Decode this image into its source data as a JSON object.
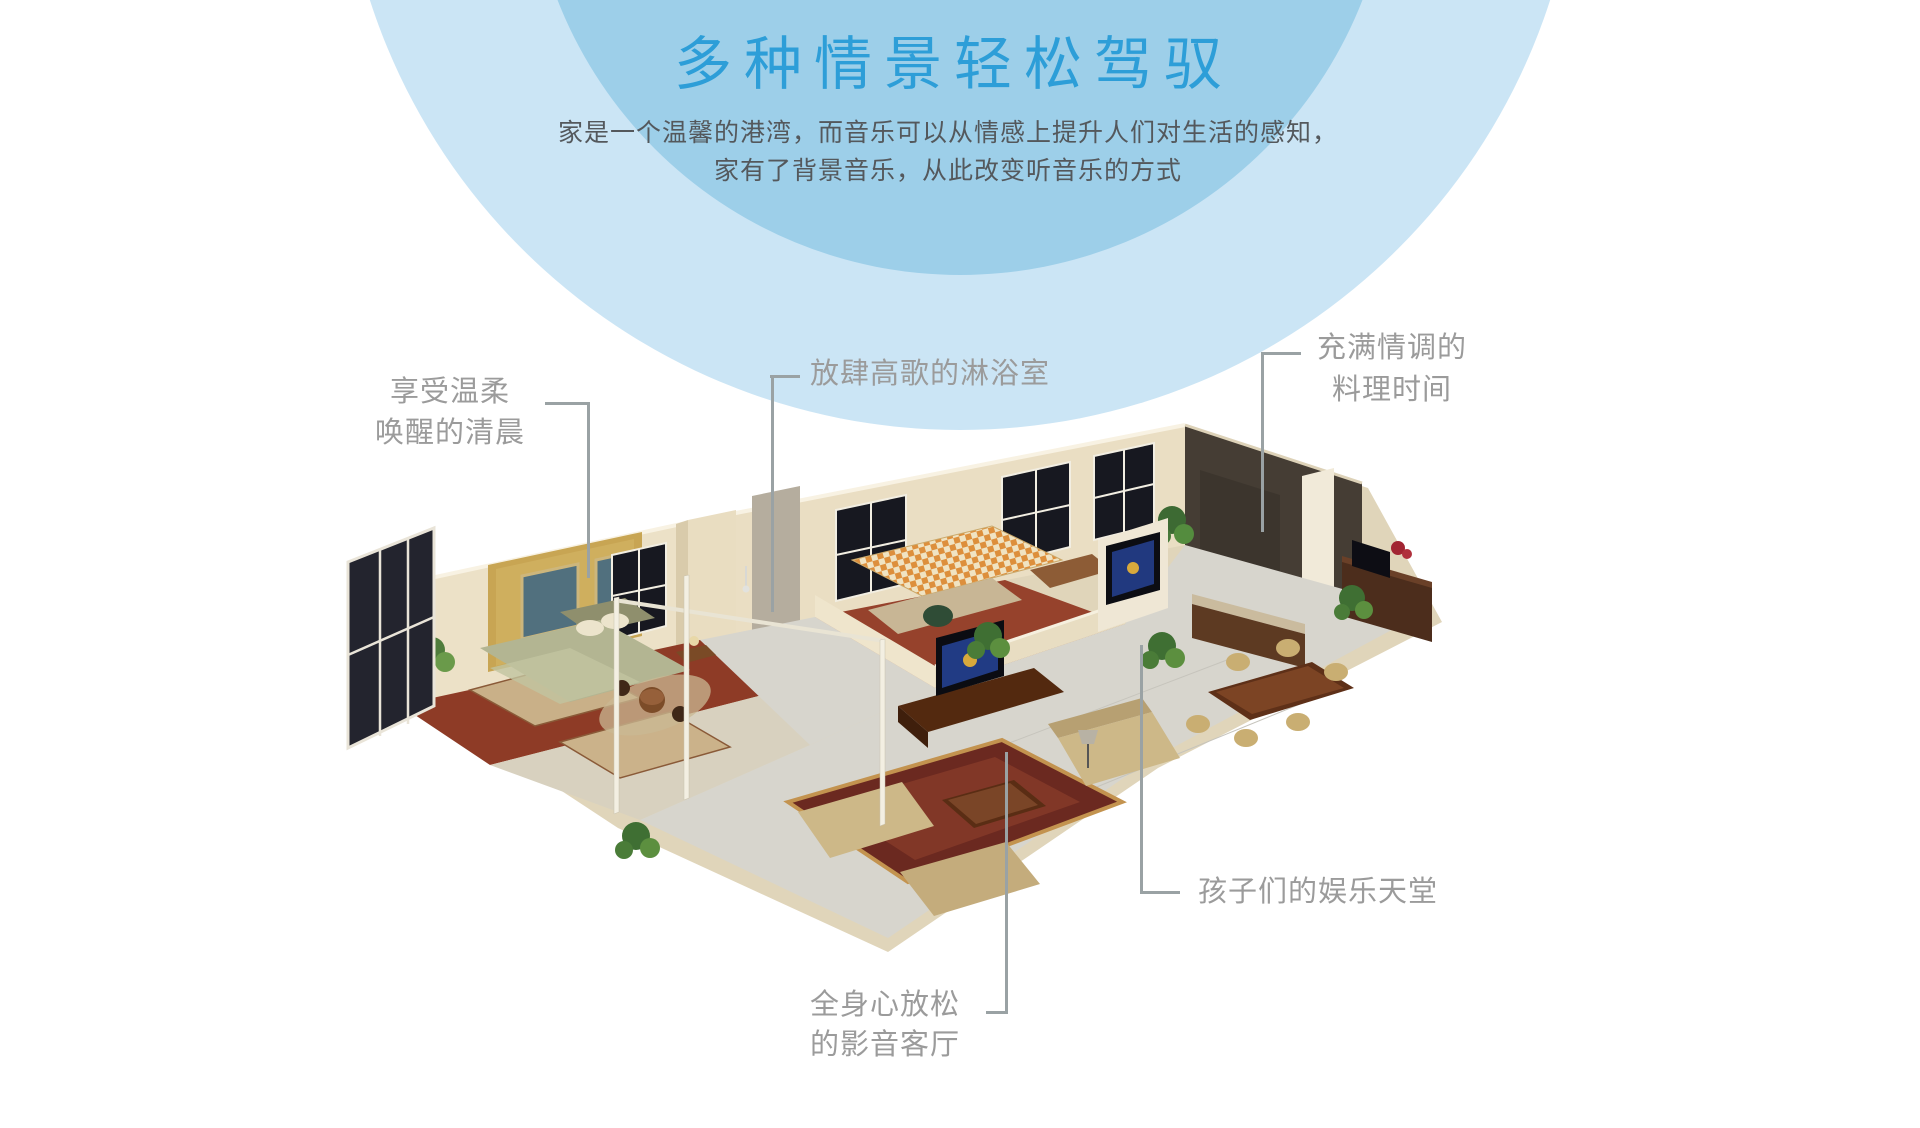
{
  "page": {
    "title": "多种情景轻松驾驭",
    "subtitle_line1": "家是一个温馨的港湾，而音乐可以从情感上提升人们对生活的感知，",
    "subtitle_line2": "家有了背景音乐，从此改变听音乐的方式"
  },
  "colors": {
    "accent_blue": "#2d9ed8",
    "circle_inner": "#9dcfe9",
    "circle_outer": "#cbe5f5",
    "subtitle_text": "#54585c",
    "callout_text": "#9b9b9b",
    "callout_line": "#9aa2a4"
  },
  "callouts": {
    "morning": {
      "line1": "享受温柔",
      "line2": "唤醒的清晨"
    },
    "shower": {
      "line1": "放肆高歌的淋浴室"
    },
    "kitchen": {
      "line1": "充满情调的",
      "line2": "料理时间"
    },
    "kids": {
      "line1": "孩子们的娱乐天堂"
    },
    "living": {
      "line1": "全身心放松",
      "line2": "的影音客厅"
    }
  }
}
